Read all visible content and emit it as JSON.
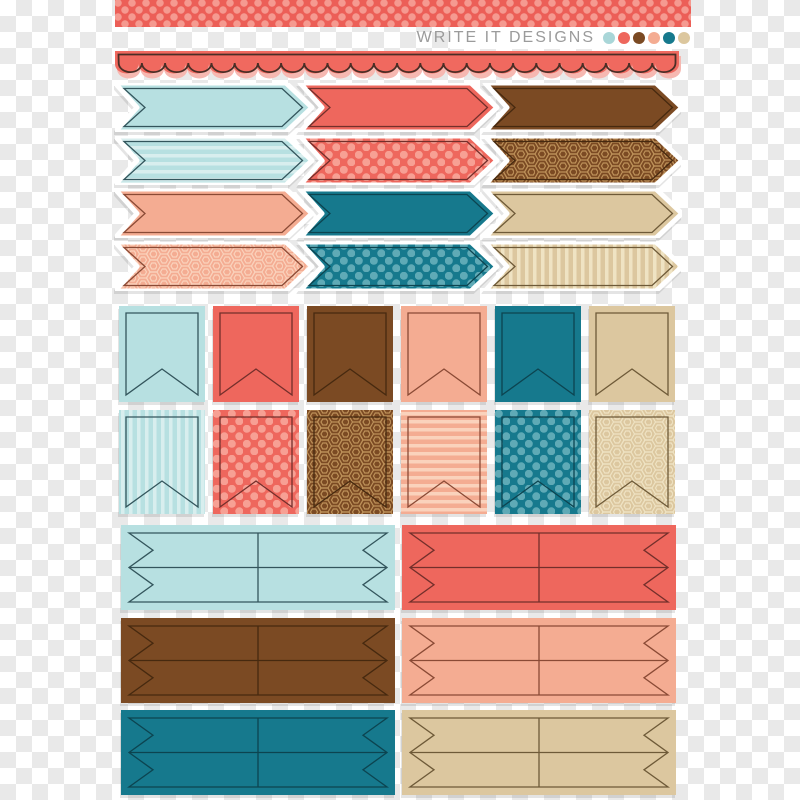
{
  "brand": {
    "name": "WRITE IT DESIGNS",
    "text_color": "#9B9B9B",
    "dot_colors": [
      "#A9D6D8",
      "#EE675D",
      "#7B4A23",
      "#F4AC92",
      "#16798D",
      "#DCC79E"
    ]
  },
  "background": {
    "checker_light": "#FFFFFF",
    "checker_dark": "#E9E9E9"
  },
  "washi_tape": {
    "base": "#EC5F57",
    "dot": "#F59A90",
    "pattern": "dots"
  },
  "scallop_border": {
    "fill": "#F0695F",
    "shadow": "#F6B8B1",
    "outline": "#4A2E26"
  },
  "palette": {
    "aqua": {
      "fill": "#B7E0E1",
      "light": "#D8EEEE",
      "outline": "#33555C"
    },
    "coral": {
      "fill": "#EE675D",
      "light": "#F7A094",
      "outline": "#732F2B"
    },
    "brown": {
      "fill": "#7B4A23",
      "light": "#BD9159",
      "outline": "#46290F"
    },
    "peach": {
      "fill": "#F4AC92",
      "light": "#FAD2BC",
      "outline": "#8A4A35"
    },
    "teal": {
      "fill": "#16798D",
      "light": "#5FAAB6",
      "outline": "#0C4450"
    },
    "tan": {
      "fill": "#DCC79F",
      "light": "#EFE3C3",
      "outline": "#6E5A38"
    }
  },
  "arrow_rows": [
    {
      "items": [
        {
          "shape": "arrow",
          "color": "aqua",
          "pattern": "solid"
        },
        {
          "shape": "arrow",
          "color": "coral",
          "pattern": "solid"
        },
        {
          "shape": "arrow",
          "color": "brown",
          "pattern": "solid"
        }
      ]
    },
    {
      "items": [
        {
          "shape": "arrow",
          "color": "aqua",
          "pattern": "h-stripes"
        },
        {
          "shape": "arrow",
          "color": "coral",
          "pattern": "dots"
        },
        {
          "shape": "arrow",
          "color": "brown",
          "pattern": "hexagons"
        }
      ]
    },
    {
      "items": [
        {
          "shape": "arrow",
          "color": "peach",
          "pattern": "solid"
        },
        {
          "shape": "arrow",
          "color": "teal",
          "pattern": "solid"
        },
        {
          "shape": "arrow",
          "color": "tan",
          "pattern": "solid"
        }
      ]
    },
    {
      "items": [
        {
          "shape": "arrow",
          "color": "peach",
          "pattern": "hexagons"
        },
        {
          "shape": "arrow",
          "color": "teal",
          "pattern": "dots"
        },
        {
          "shape": "arrow",
          "color": "tan",
          "pattern": "v-stripes"
        }
      ]
    }
  ],
  "flag_rows": [
    {
      "items": [
        {
          "shape": "pennant",
          "color": "aqua",
          "pattern": "solid"
        },
        {
          "shape": "pennant",
          "color": "coral",
          "pattern": "solid"
        },
        {
          "shape": "pennant",
          "color": "brown",
          "pattern": "solid"
        },
        {
          "shape": "pennant",
          "color": "peach",
          "pattern": "solid"
        },
        {
          "shape": "pennant",
          "color": "teal",
          "pattern": "solid"
        },
        {
          "shape": "pennant",
          "color": "tan",
          "pattern": "solid"
        }
      ]
    },
    {
      "items": [
        {
          "shape": "pennant",
          "color": "aqua",
          "pattern": "v-stripes"
        },
        {
          "shape": "pennant",
          "color": "coral",
          "pattern": "dots"
        },
        {
          "shape": "pennant",
          "color": "brown",
          "pattern": "hexagons"
        },
        {
          "shape": "pennant",
          "color": "peach",
          "pattern": "h-stripes"
        },
        {
          "shape": "pennant",
          "color": "teal",
          "pattern": "dots"
        },
        {
          "shape": "pennant",
          "color": "tan",
          "pattern": "hexagons"
        }
      ]
    }
  ],
  "ribbon_rows": [
    {
      "items": [
        {
          "shape": "double-ribbon",
          "color": "aqua",
          "pattern": "solid"
        },
        {
          "shape": "double-ribbon",
          "color": "coral",
          "pattern": "solid"
        }
      ]
    },
    {
      "items": [
        {
          "shape": "double-ribbon",
          "color": "brown",
          "pattern": "solid"
        },
        {
          "shape": "double-ribbon",
          "color": "peach",
          "pattern": "solid"
        }
      ]
    },
    {
      "items": [
        {
          "shape": "double-ribbon",
          "color": "teal",
          "pattern": "solid"
        },
        {
          "shape": "double-ribbon",
          "color": "tan",
          "pattern": "solid"
        }
      ]
    }
  ]
}
